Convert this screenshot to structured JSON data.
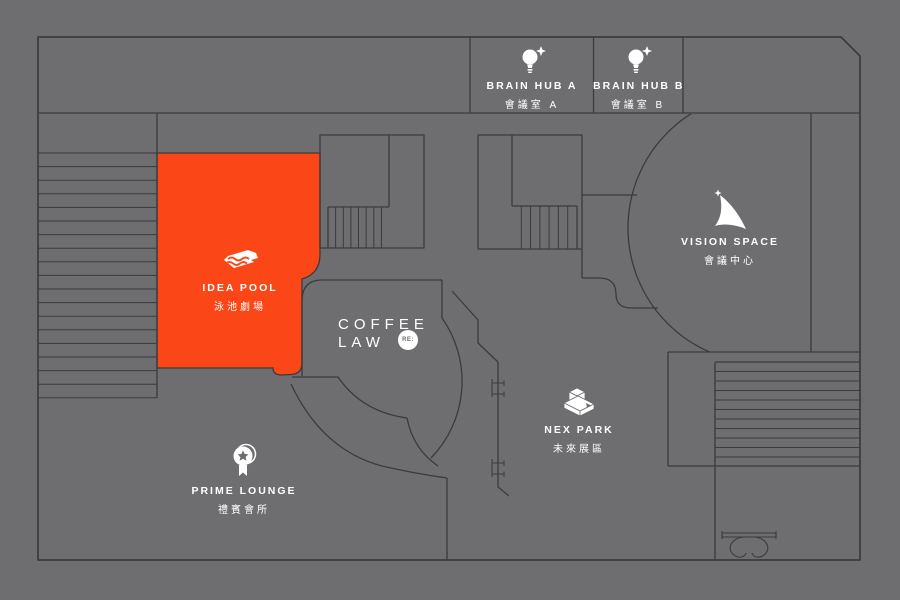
{
  "map": {
    "colors": {
      "background": "#6E6E71",
      "wall": "#3B3B3E",
      "highlight": "#FB4617",
      "label_text": "#FFFFFF"
    },
    "rooms": {
      "brain_hub_a": {
        "name": "BRAIN HUB A",
        "name_zh": "會議室 A",
        "icon": "lightbulb-sparkle-icon"
      },
      "brain_hub_b": {
        "name": "BRAIN HUB B",
        "name_zh": "會議室 B",
        "icon": "lightbulb-sparkle-icon"
      },
      "vision_space": {
        "name": "VISION SPACE",
        "name_zh": "會議中心",
        "icon": "beacon-swoosh-icon"
      },
      "idea_pool": {
        "name": "IDEA POOL",
        "name_zh": "泳池劇場",
        "icon": "wave-stage-icon",
        "highlighted": true
      },
      "coffee_law": {
        "name_line1": "COFFEE",
        "name_line2": "LAW",
        "badge": "RE:"
      },
      "nex_park": {
        "name": "NEX PARK",
        "name_zh": "未來展區",
        "icon": "exhibit-box-icon"
      },
      "prime_lounge": {
        "name": "PRIME LOUNGE",
        "name_zh": "禮賓會所",
        "icon": "medal-ribbon-icon"
      }
    }
  }
}
